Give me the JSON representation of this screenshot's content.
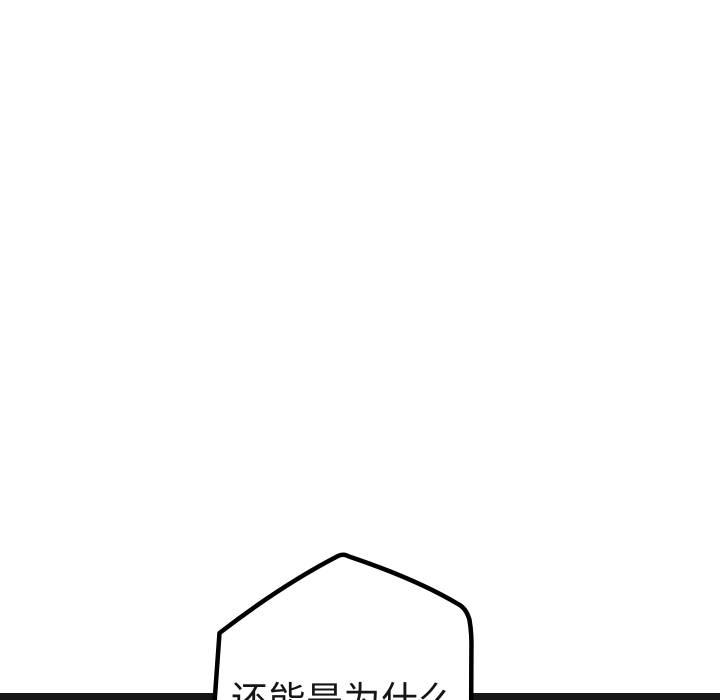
{
  "canvas": {
    "width": 720,
    "height": 700,
    "background_color": "#ffffff"
  },
  "panel": {
    "bottom_border_color": "#161616"
  },
  "speech_bubble": {
    "text": "还能是为什么",
    "fill_color": "#ffffff",
    "stroke_color": "#000000",
    "text_color": "#151515"
  }
}
